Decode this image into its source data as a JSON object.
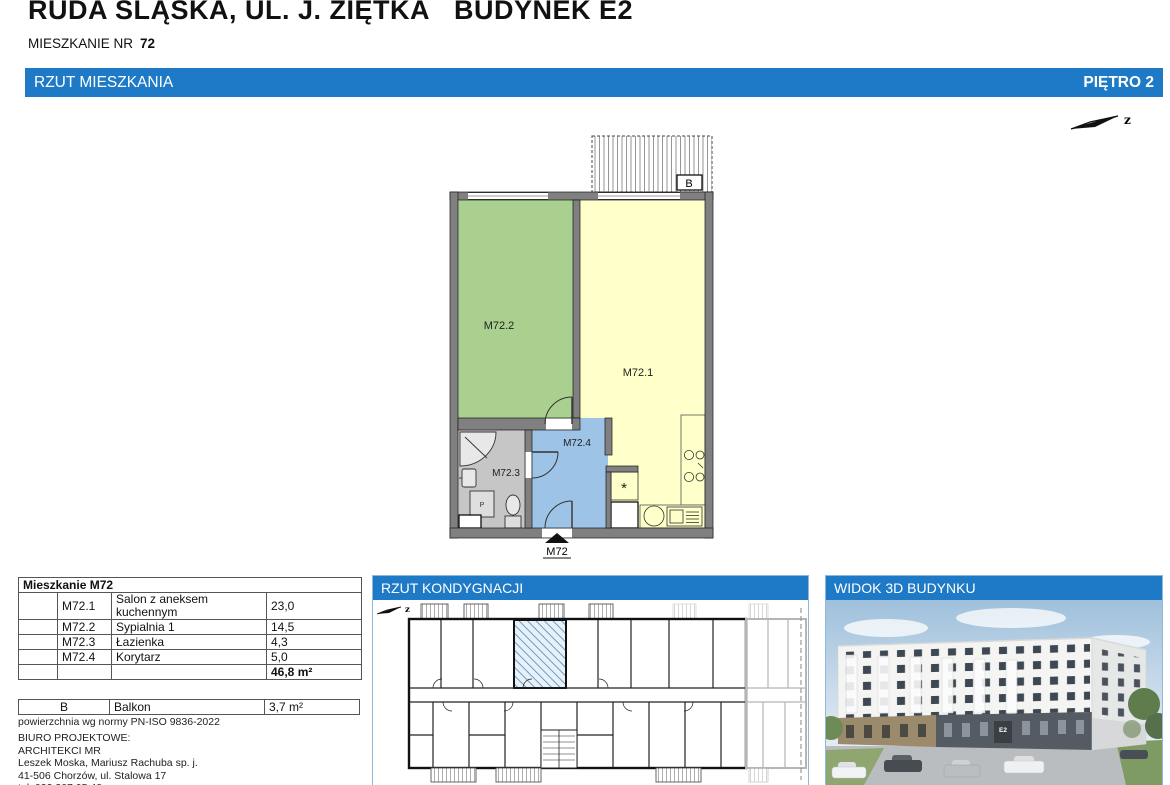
{
  "page": {
    "title": "RUDA ŚLĄSKA, UL. J. ZIĘTKA",
    "title_building": "BUDYNEK E2",
    "apartment_label": "MIESZKANIE NR",
    "apartment_number": "72"
  },
  "main_bar": {
    "left": "RZUT MIESZKANIA",
    "right": "PIĘTRO 2"
  },
  "compass": {
    "label": "z"
  },
  "plan": {
    "rooms": {
      "living": "M72.1",
      "bedroom": "M72.2",
      "bathroom": "M72.3",
      "corridor": "M72.4"
    },
    "balcony_label": "B",
    "entrance_label": "M72",
    "washer_label": "P",
    "shaft_label": "*"
  },
  "apartment_table": {
    "title": "Mieszkanie M72",
    "rows": [
      {
        "code": "M72.1",
        "name": "Salon z aneksem kuchennym",
        "area": "23,0"
      },
      {
        "code": "M72.2",
        "name": "Sypialnia 1",
        "area": "14,5"
      },
      {
        "code": "M72.3",
        "name": "Łazienka",
        "area": "4,3"
      },
      {
        "code": "M72.4",
        "name": "Korytarz",
        "area": "5,0"
      }
    ],
    "total": "46,8 m²"
  },
  "balcony_table": {
    "code": "B",
    "name": "Balkon",
    "area": "3,7 m²"
  },
  "norm_note": "powierzchnia wg normy PN-ISO 9836-2022",
  "office": {
    "line1": "BIURO PROJEKTOWE:",
    "line2": "ARCHITEKCI MR",
    "line3": "Leszek Moska, Mariusz Rachuba sp. j.",
    "line4": "41-506 Chorzów, ul. Stalowa 17",
    "line5": "tel. 032 307 05 48."
  },
  "floor_panel": {
    "title": "RZUT KONDYGNACJI",
    "compass_label": "z"
  },
  "view3d_panel": {
    "title": "WIDOK 3D BUDYNKU",
    "building_label": "E2"
  },
  "colors": {
    "accent_blue": "#1e7ac6",
    "room_living": "#ffffc9",
    "room_bedroom": "#a9d08e",
    "room_bathroom": "#c6c6c6",
    "room_corridor": "#9dc3e6",
    "wall": "#808080"
  }
}
